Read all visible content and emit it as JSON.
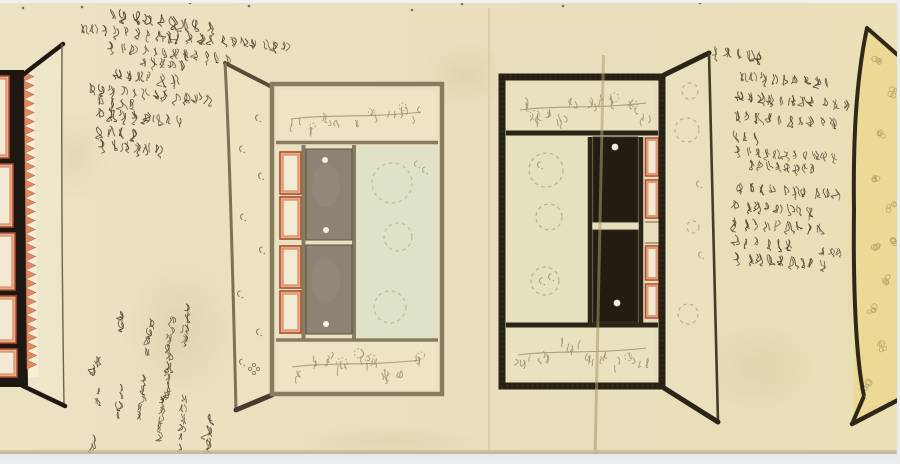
{
  "document": {
    "kind": "hand-painted scroll page, ink and color on paper",
    "main_label": "上白御車",
    "transcription_note": "approximate reading of cursive"
  },
  "colors": {
    "paper": "#eadfbe",
    "paper_edge_shadow": "#b7aa8b",
    "scan_margin": "#edeff1",
    "ink": "#4e3e2b",
    "frame_wood": "#877b62",
    "frame_black": "#2b2418",
    "lacquer_black": "#221c13",
    "panel_olive": "#8d8374",
    "panel_celadon": "#dfe2c6",
    "panel_cream": "#e9e2bf",
    "red_border": "#a8492b",
    "salmon_border": "#e29a73",
    "sawtooth_orange": "#db8a61",
    "yellow_panel": "#ebd995",
    "floral_ink": "#9a8c6b",
    "yellow_motif": "#b5a76a",
    "crease": "#b49f74",
    "fitting_dot": "#f5f1e4"
  },
  "annotations": {
    "top_left": [
      {
        "text": "建物見御車両御名十",
        "x": 106,
        "y": 12,
        "rot": 7,
        "fs": 11
      },
      {
        "text": "納代ゆ比地様上朱ニ而村砥又袖こち例ヲ知ル",
        "x": 80,
        "y": 27,
        "rot": 5,
        "fs": 9.5
      },
      {
        "text": "御簾縁取りゆ入樓へ地り茸",
        "x": 108,
        "y": 45,
        "rot": 6,
        "fs": 9.5
      },
      {
        "text": "中静樓事静",
        "x": 140,
        "y": 60,
        "rot": 5,
        "fs": 8.5
      },
      {
        "text": "物見三枚黒塗",
        "x": 113,
        "y": 73,
        "rot": 5,
        "fs": 10
      },
      {
        "text": "金物白ありと悦見堂段倉成",
        "x": 87,
        "y": 87,
        "rot": 5,
        "fs": 9.5
      },
      {
        "text": "不打付ニ",
        "x": 97,
        "y": 100,
        "rot": 4,
        "fs": 9.5
      },
      {
        "text": "下裏白ミ縅毯自然",
        "x": 97,
        "y": 112,
        "rot": 5,
        "fs": 10
      },
      {
        "text": "所々手傷",
        "x": 95,
        "y": 129,
        "rot": 4,
        "fs": 10
      },
      {
        "text": "御棚金物条々",
        "x": 99,
        "y": 143,
        "rot": 5,
        "fs": 10
      }
    ],
    "bottom_left": [
      {
        "text": "御棚金物",
        "x": 190,
        "y": 303,
        "rot": 8,
        "fs": 9,
        "vert": true
      },
      {
        "text": "樓室白字",
        "x": 173,
        "y": 316,
        "rot": 8,
        "fs": 8,
        "vert": true
      },
      {
        "text": "金物斗踏",
        "x": 152,
        "y": 318,
        "rot": 8,
        "fs": 8.5,
        "vert": true
      },
      {
        "text": "散物",
        "x": 124,
        "y": 310,
        "rot": 8,
        "fs": 9,
        "vert": true
      },
      {
        "text": "手傷",
        "x": 100,
        "y": 356,
        "rot": 20,
        "fs": 9,
        "vert": true
      },
      {
        "text": "下裏白緞縅",
        "x": 172,
        "y": 352,
        "rot": 8,
        "fs": 8.5,
        "vert": true
      },
      {
        "text": "御官成ニ白",
        "x": 146,
        "y": 374,
        "rot": 8,
        "fs": 8.5,
        "vert": true
      },
      {
        "text": "袖冬毛田",
        "x": 122,
        "y": 381,
        "rot": 8,
        "fs": 8.5,
        "vert": true
      },
      {
        "text": "編氏",
        "x": 99,
        "y": 386,
        "rot": 8,
        "fs": 8.5,
        "vert": true
      },
      {
        "text": "御投案ニ編",
        "x": 164,
        "y": 396,
        "rot": 6,
        "fs": 8,
        "vert": true
      },
      {
        "text": "網代二三白袖",
        "x": 186,
        "y": 394,
        "rot": 6,
        "fs": 8.5,
        "vert": true
      },
      {
        "text": "上白御車",
        "x": 211,
        "y": 413,
        "rot": 5,
        "fs": 10.5,
        "vert": true
      },
      {
        "text": "袖ニ悦",
        "x": 95,
        "y": 432,
        "rot": 8,
        "fs": 8.5,
        "vert": true
      }
    ],
    "right": [
      {
        "text": "公卿様居十",
        "x": 712,
        "y": 50,
        "rot": 6,
        "fs": 10
      },
      {
        "text": "納代白洲ヘ入氏連携",
        "x": 739,
        "y": 75,
        "rot": 4,
        "fs": 9.5
      },
      {
        "text": "物見前者又白飛え滴り知",
        "x": 735,
        "y": 95,
        "rot": 4,
        "fs": 9.5
      },
      {
        "text": "立枚柳見又甲氈縁も氏",
        "x": 733,
        "y": 114,
        "rot": 4,
        "fs": 9.5
      },
      {
        "text": "経鉾同",
        "x": 731,
        "y": 134,
        "rot": 4,
        "fs": 9.5
      },
      {
        "text": "御簾庫玉採繰説既祭極蓮",
        "x": 735,
        "y": 149,
        "rot": 4,
        "fs": 8.5
      },
      {
        "text": "連枝な電煙ミ近る",
        "x": 747,
        "y": 163,
        "rot": 4,
        "fs": 8
      },
      {
        "text": "引キ手黒田塗改まみと",
        "x": 737,
        "y": 186,
        "rot": 4,
        "fs": 9.5
      },
      {
        "text": "下操ミ直四つ書傷",
        "x": 732,
        "y": 204,
        "rot": 4,
        "fs": 9.5
      },
      {
        "text": "仁操田寺既祥田地絵",
        "x": 730,
        "y": 221,
        "rot": 4,
        "fs": 9.5
      },
      {
        "text": "雲仲水与求く",
        "x": 732,
        "y": 239,
        "rot": 4,
        "fs": 9.5
      },
      {
        "text": "御操ミ川氏祥い有色",
        "x": 734,
        "y": 256,
        "rot": 4,
        "fs": 9.5
      }
    ],
    "tiny": [
      {
        "text": "小サミ",
        "x": 820,
        "y": 250,
        "rot": 4,
        "fs": 7
      }
    ]
  }
}
